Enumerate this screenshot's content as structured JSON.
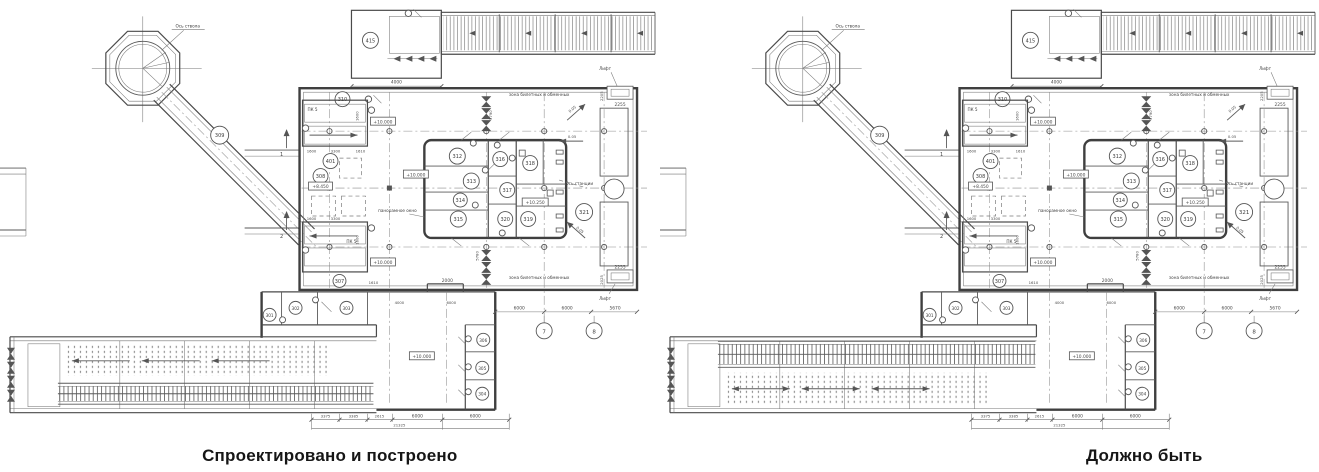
{
  "panels": [
    {
      "caption": "Спроектировано и построено",
      "variant": "as_built"
    },
    {
      "caption": "Должно быть",
      "variant": "should_be"
    }
  ],
  "plan": {
    "texts": {
      "axis_shaft": "Ось ствола",
      "axis_station": "Ось станции",
      "zone_top": "зона билетных и обменных",
      "zone_bottom": "зона билетных и обменных",
      "panoramic": "панорамное окно",
      "lift_top": "Лифт",
      "lift_bottom": "Лифт",
      "pk5_a": "ПК 5",
      "pk5_b": "ПК 5",
      "sec1": "1",
      "sec2": "2",
      "slope1": "0.05",
      "slope2": "0.05",
      "slope3": "0.05"
    },
    "rooms": {
      "r301": "301",
      "r302": "302",
      "r303": "303",
      "r304": "304",
      "r305": "305",
      "r306": "306",
      "r307": "307",
      "r308": "308",
      "r309": "309",
      "r310": "310",
      "r312": "312",
      "r313": "313",
      "r314": "314",
      "r315": "315",
      "r316": "316",
      "r317": "317",
      "r318": "318",
      "r319": "319",
      "r320": "320",
      "r321": "321",
      "r401": "401",
      "r415": "415"
    },
    "elevations": {
      "e10_stair_top": "+10.000",
      "e10_stair_bottom": "+10.000",
      "e10_main": "+10.000",
      "e10_right": "+10.000",
      "e10_conc": "+10.000",
      "e8450": "+8.450",
      "e10250": "+10.250"
    },
    "dims": {
      "top4000": "4000",
      "hall2000": "2000",
      "c4000": "4000",
      "c6000": "6000",
      "v5790": "5790",
      "v5780": "5780",
      "v1600a": "1600",
      "v1600b": "1600",
      "st1600a": "1600",
      "st3300a": "3300",
      "st1610a": "1610",
      "st1600b": "1600",
      "st3300b": "3300",
      "st1610b": "1610",
      "lift2255t": "2255",
      "lift2205": "2205",
      "lift2255b": "2255",
      "lift2025": "2025",
      "b3375": "3375",
      "b3385": "3385",
      "b2615": "2615",
      "b6000a": "6000",
      "b6000b": "6000",
      "b21325": "21325",
      "r6000a": "6000",
      "r6000b": "6000",
      "r5670": "5670"
    },
    "grid": {
      "g7": "7",
      "g8": "8"
    }
  }
}
